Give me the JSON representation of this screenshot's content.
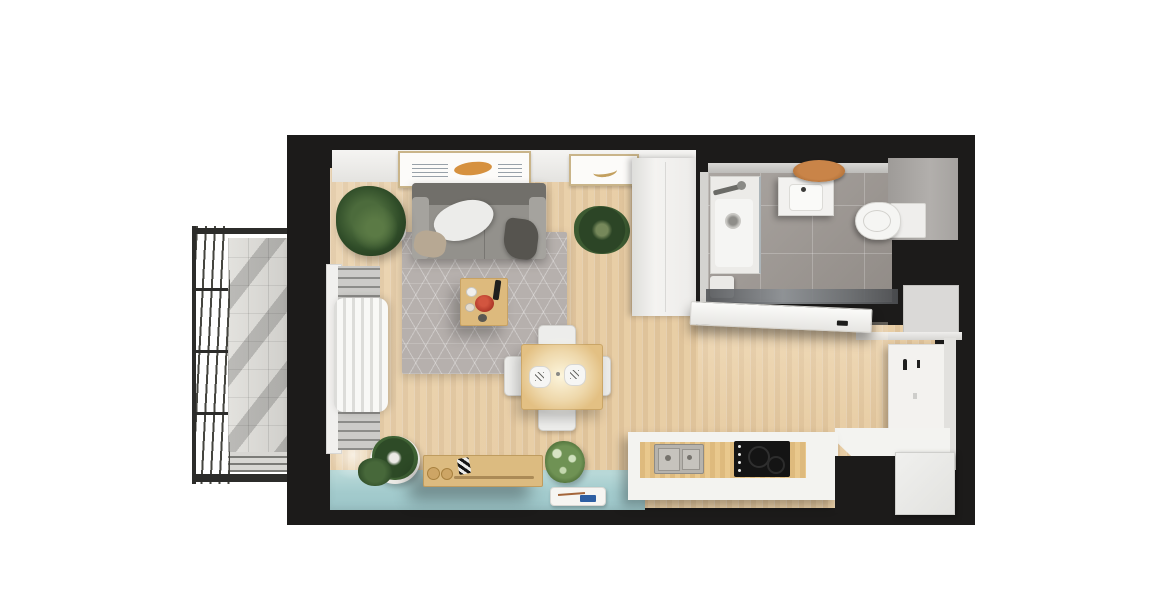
{
  "scene": {
    "title": "Studio apartment — top-down 3D floor-plan render",
    "rooms": {
      "balcony": {
        "label": "Balcony"
      },
      "living_area": {
        "label": "Living area"
      },
      "dining_area": {
        "label": "Dining area"
      },
      "kitchen": {
        "label": "Kitchen"
      },
      "bathroom": {
        "label": "Bathroom"
      },
      "entry_hall": {
        "label": "Entry hall"
      }
    },
    "objects": {
      "railing": {
        "label": "Balcony railing"
      },
      "sofa": {
        "label": "Gray sofa with cushions"
      },
      "white_pillow": {
        "label": "White pillow"
      },
      "beige_pillow": {
        "label": "Beige pillow"
      },
      "dark_throw": {
        "label": "Dark throw blanket"
      },
      "rug": {
        "label": "Gray rug with hexagon pattern"
      },
      "coffee_table": {
        "label": "Wooden coffee table"
      },
      "red_bowl": {
        "label": "Red bowl"
      },
      "remote": {
        "label": "Black remote"
      },
      "dining_table": {
        "label": "Square wooden dining table"
      },
      "dining_chair": {
        "label": "White dining chair",
        "count": 4
      },
      "place_setting": {
        "label": "Place setting",
        "count": 2
      },
      "pendant_glow": {
        "label": "Pendant light glow"
      },
      "wall_art_large": {
        "label": "Framed artwork (large)"
      },
      "wall_art_small": {
        "label": "Framed artwork (small)"
      },
      "wardrobe": {
        "label": "White wardrobe"
      },
      "window": {
        "label": "Balcony window"
      },
      "radiator": {
        "label": "Radiator"
      },
      "curtain": {
        "label": "White sheer curtain"
      },
      "plant": {
        "label": "Green potted plant",
        "count": 5
      },
      "bench": {
        "label": "Low wooden bench"
      },
      "stationery_tray": {
        "label": "White tray with pen and card"
      },
      "kitchen_counter": {
        "label": "L-shaped kitchen counter"
      },
      "kitchen_sink": {
        "label": "Double stainless-steel sink"
      },
      "cooktop": {
        "label": "Black cooktop"
      },
      "white_cabinet": {
        "label": "White cabinet"
      },
      "shower": {
        "label": "Walk-in shower"
      },
      "washbasin": {
        "label": "Washbasin"
      },
      "wood_tray": {
        "label": "Round wooden tray"
      },
      "toilet": {
        "label": "Toilet"
      },
      "cistern": {
        "label": "Toilet cistern"
      },
      "bath_mat": {
        "label": "Bath mat"
      },
      "mirror": {
        "label": "Bathroom mirror"
      },
      "bathroom_door": {
        "label": "Open bathroom door"
      },
      "coat_hooks": {
        "label": "Entry panel with coat hooks"
      },
      "alcove": {
        "label": "Entry alcove"
      }
    },
    "palette": {
      "background": "#ffffff",
      "walls": "#1c1b1a",
      "wood_floor": "#e7cda5",
      "teal_floor": "#a7cccd",
      "rug_gray": "#b6b0ad",
      "bathroom_tile": "#9d9792",
      "counter_white": "#f3f3f0",
      "furniture_wood": "#ddba7d",
      "plant_green": "#3d5c33",
      "accent_red": "#b5372c",
      "accent_orange": "#d6913f",
      "accent_blue": "#2e5fa3",
      "balcony_concrete": "#d7d6d2",
      "railing_dark": "#3a3a38"
    }
  }
}
